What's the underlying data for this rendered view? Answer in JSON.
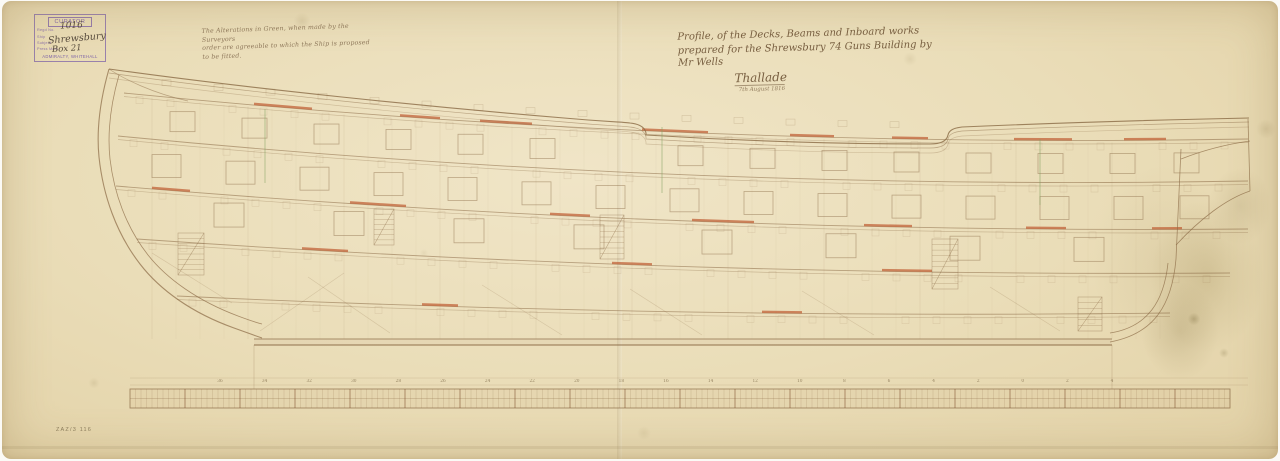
{
  "stamp": {
    "title": "CURATOR",
    "labels": [
      "Regd No.",
      "Ship",
      "Subject",
      "Press Mark"
    ],
    "reg_no": "1016",
    "ship": "Shrewsbury",
    "press_mark": "Box 21",
    "footer": "ADMIRALTY, WHITEHALL",
    "ink_color": "#7e63a8"
  },
  "note": {
    "line1": "The Alterations in Green, when made by the Surveyors",
    "line2": "order are agreeable to which the Ship is proposed to be fitted."
  },
  "title_block": {
    "line1": "Profile, of the Decks, Beams and Inboard works",
    "line2": "prepared for the Shrewsbury 74 Guns Building by",
    "line3": "Mr Wells",
    "signature": "Thallade",
    "date": "7th August 1816"
  },
  "reference_number": "ZAZ/3 116",
  "colors": {
    "paper": "#eadcb6",
    "ink": "#8a6a45",
    "red": "#bf5b31",
    "green": "#7fa05e",
    "stamp": "#7e63a8"
  },
  "drawing": {
    "ink": "#8a6a45",
    "red": "#bf5b31",
    "green": "#7fa05e",
    "rail_path": "M107,68 C250,88 430,106 562,117 C606,121 622,121 628,122 C638,123 643,127 644,132 L644,134 C740,140 842,143 928,143 C941,143 945,139 946,134 C947,129 952,127 960,126 C1052,122 1152,119 1247,117",
    "rail_offsets": [
      0,
      4,
      9
    ],
    "headrail_path": "M107,68 C122,78 150,92 186,100",
    "stem_paths": [
      "M107,68 C99,96 94,126 97,156 C101,194 114,232 138,263 C158,289 190,312 232,327 C246,332 254,335 260,337",
      "M117,74 C109,102 105,130 108,158 C112,192 124,226 146,254 C165,278 196,300 236,315 C244,318 252,321 260,323"
    ],
    "stern_paths": [
      "M1108,341 C1152,333 1170,304 1174,258 L1179,148",
      "M1108,332 C1146,326 1162,300 1166,262",
      "M1174,244 C1198,218 1224,198 1248,190",
      "M1179,158 C1202,149 1226,143 1248,140",
      "M1246,118 L1248,190"
    ],
    "keel": {
      "x1": 252,
      "x2": 1110,
      "y_top": 338,
      "y_bot": 344
    },
    "decks": [
      {
        "xf": 122,
        "xa": 1246,
        "yf": 92,
        "ym": 148,
        "ya": 138,
        "red": [
          [
            252,
            58
          ],
          [
            398,
            40
          ],
          [
            478,
            52
          ],
          [
            640,
            66
          ],
          [
            788,
            44
          ],
          [
            890,
            36
          ],
          [
            1012,
            58
          ],
          [
            1122,
            42
          ]
        ]
      },
      {
        "xf": 116,
        "xa": 1246,
        "yf": 135,
        "ym": 190,
        "ya": 180,
        "red": []
      },
      {
        "xf": 114,
        "xa": 1246,
        "yf": 185,
        "ym": 233,
        "ya": 228,
        "red": [
          [
            150,
            38
          ],
          [
            348,
            56
          ],
          [
            548,
            40
          ],
          [
            690,
            62
          ],
          [
            862,
            48
          ],
          [
            1024,
            40
          ],
          [
            1150,
            30
          ]
        ]
      },
      {
        "xf": 135,
        "xa": 1228,
        "yf": 238,
        "ym": 276,
        "ya": 272,
        "red": [
          [
            300,
            46
          ],
          [
            610,
            40
          ],
          [
            880,
            50
          ]
        ]
      },
      {
        "xf": 175,
        "xa": 1168,
        "yf": 295,
        "ym": 318,
        "ya": 312,
        "red": [
          [
            420,
            36
          ],
          [
            760,
            40
          ]
        ]
      }
    ],
    "port_rows": [
      {
        "deck": 0,
        "dy": 13,
        "w": 25,
        "h": 20,
        "xs": [
          168,
          240,
          312,
          384,
          456,
          528,
          676,
          748,
          820,
          892,
          964,
          1036,
          1108,
          1172
        ]
      },
      {
        "deck": 1,
        "dy": 14,
        "w": 29,
        "h": 23,
        "xs": [
          150,
          224,
          298,
          372,
          446,
          520,
          594,
          668,
          742,
          816,
          890,
          964,
          1038,
          1112,
          1178
        ]
      },
      {
        "deck": 2,
        "dy": 8,
        "w": 30,
        "h": 24,
        "xs": [
          212,
          332,
          452,
          572,
          700,
          824,
          948,
          1072
        ]
      }
    ],
    "frames": {
      "x1": 150,
      "x2": 1158,
      "step": 24
    },
    "timberheads": {
      "x1": 160,
      "x2": 930,
      "step": 52,
      "gap": [
        628,
        662
      ]
    },
    "ladders": [
      {
        "x": 176,
        "y": 232,
        "w": 26,
        "h": 42,
        "steps": 8
      },
      {
        "x": 372,
        "y": 208,
        "w": 20,
        "h": 36,
        "steps": 7
      },
      {
        "x": 598,
        "y": 214,
        "w": 24,
        "h": 44,
        "steps": 8
      },
      {
        "x": 930,
        "y": 238,
        "w": 26,
        "h": 50,
        "steps": 9
      },
      {
        "x": 1076,
        "y": 296,
        "w": 24,
        "h": 34,
        "steps": 6
      }
    ],
    "diagonals": [
      "M258,330 L342,272",
      "M388,332 L306,276",
      "M560,334 L480,284",
      "M700,334 L628,288",
      "M872,334 L800,290",
      "M1058,330 L988,286",
      "M150,252 L230,302"
    ],
    "green_marks": [
      [
        263,
        108,
        263,
        182
      ],
      [
        660,
        126,
        660,
        192
      ],
      [
        1038,
        138,
        1038,
        204
      ]
    ],
    "guides": [
      [
        128,
        377,
        1246,
        377
      ],
      [
        128,
        384,
        1246,
        384
      ]
    ],
    "perpendiculars": [
      [
        252,
        344,
        252,
        388
      ],
      [
        1110,
        344,
        1110,
        388
      ]
    ],
    "ruler": {
      "x1": 128,
      "x2": 1228,
      "y1": 388,
      "y2": 407,
      "tick_step": 5.5
    },
    "stations": {
      "y": 381,
      "x1": 218,
      "step": 44.6,
      "labels": [
        "36",
        "34",
        "32",
        "30",
        "28",
        "26",
        "24",
        "22",
        "20",
        "18",
        "16",
        "14",
        "12",
        "10",
        "8",
        "6",
        "4",
        "2",
        "0",
        "2",
        "4"
      ]
    }
  }
}
